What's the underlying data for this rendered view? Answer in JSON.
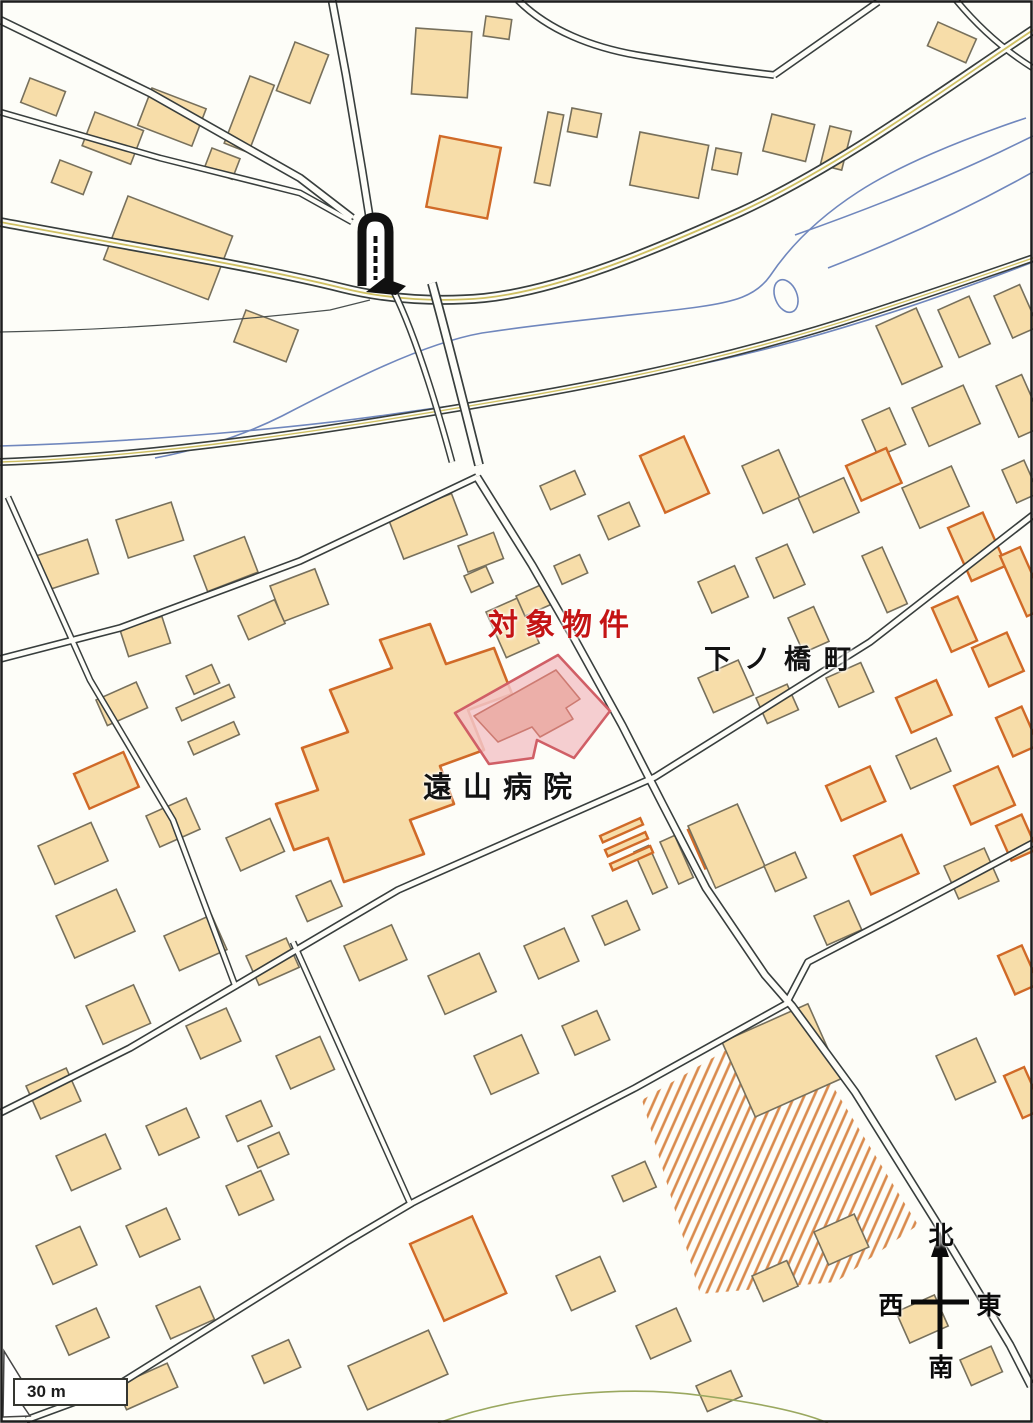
{
  "map": {
    "type": "scanned residential map (Zenrin style) showing a subject property near Toyama Hospital",
    "labels": {
      "subject_property": "対象物件",
      "district": "下ノ橋町",
      "hospital": "遠山病院"
    },
    "compass": {
      "north": "北",
      "south": "南",
      "east": "東",
      "west": "西"
    },
    "scale_bar": {
      "label": "30 m"
    },
    "symbols": {
      "monument": "monument-map-symbol",
      "compass": "compass-rose"
    },
    "colors": {
      "bg": "#fdfdf8",
      "building_fill": "#f7dda9",
      "building_stroke": "#77705c",
      "building_stroke_orange": "#d06a28",
      "road_stroke": "#383e3d",
      "river_stroke": "#7087bd",
      "center_line": "#cfc063",
      "hatch_stroke": "#d98a4c",
      "highlight_fill": "#f3c6c9",
      "highlight_stroke": "#d05f66",
      "highlight_building_fill": "#ecafa9",
      "subject_text_color": "#c41414",
      "label_text_color": "#121212"
    }
  }
}
